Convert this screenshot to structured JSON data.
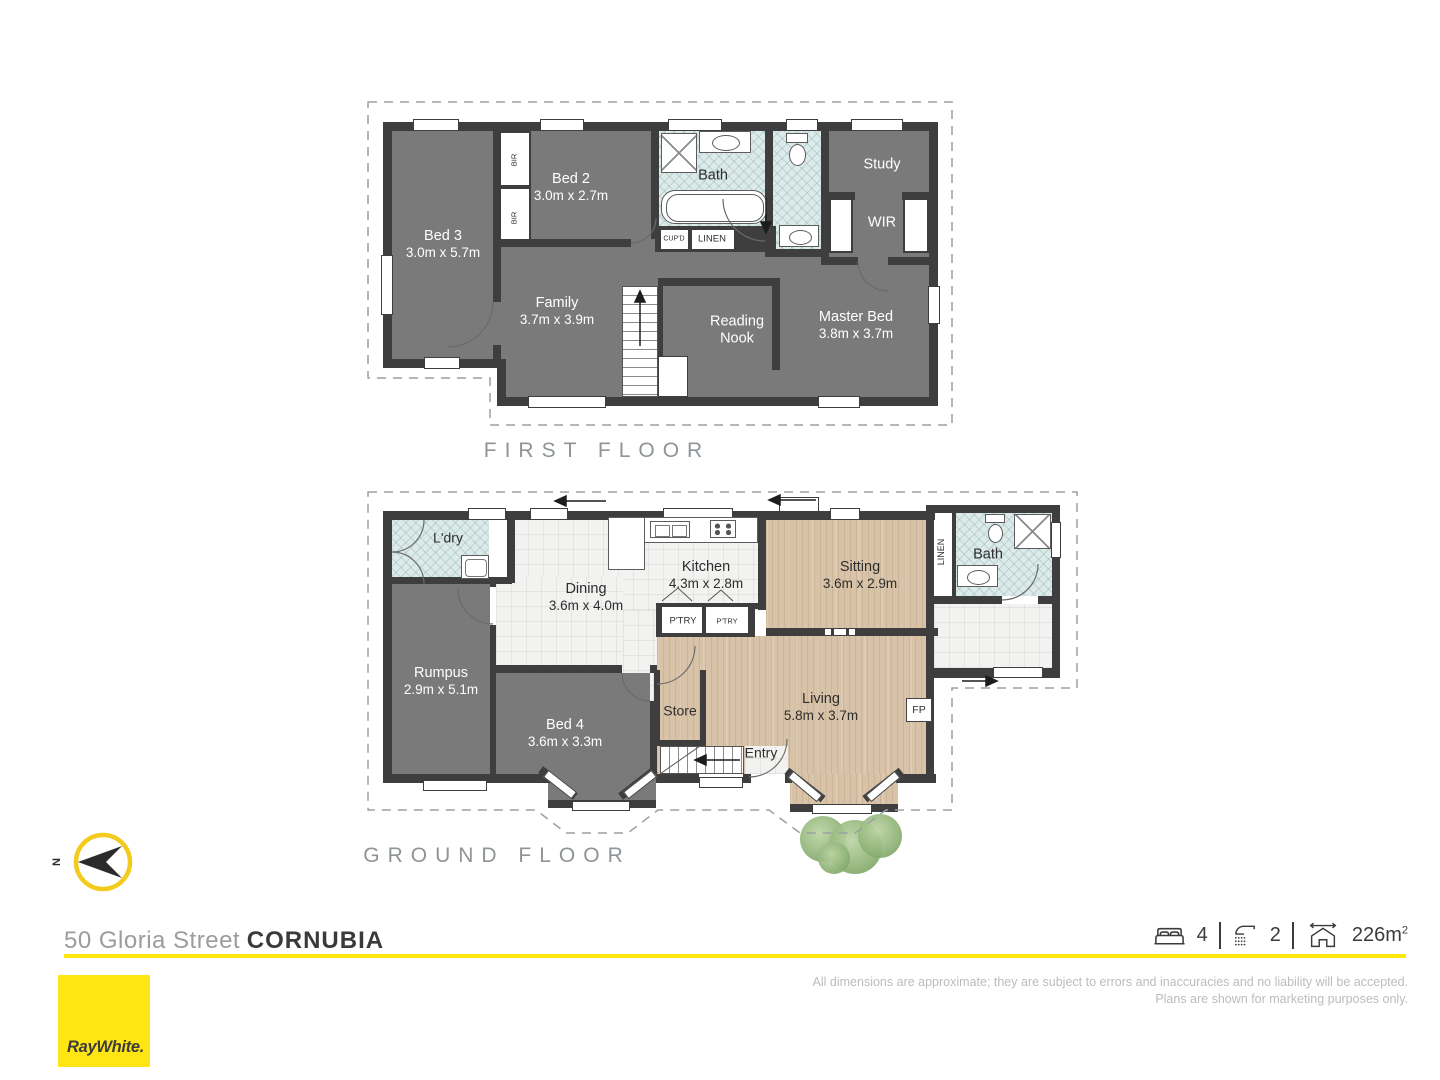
{
  "first_floor": {
    "title": "FIRST FLOOR",
    "rooms": {
      "bed3_name": "Bed 3",
      "bed3_dims": "3.0m x 5.7m",
      "bed2_name": "Bed 2",
      "bed2_dims": "3.0m x 2.7m",
      "bath": "Bath",
      "study": "Study",
      "wir": "WIR",
      "family_name": "Family",
      "family_dims": "3.7m x 3.9m",
      "nook_line1": "Reading",
      "nook_line2": "Nook",
      "master_name": "Master Bed",
      "master_dims": "3.8m x 3.7m",
      "cupd": "CUP'D",
      "linen": "LINEN",
      "bir_top": "BIR",
      "bir_bottom": "BIR"
    }
  },
  "ground_floor": {
    "title": "GROUND FLOOR",
    "rooms": {
      "laundry": "L'dry",
      "dining_name": "Dining",
      "dining_dims": "3.6m x 4.0m",
      "kitchen_name": "Kitchen",
      "kitchen_dims": "4.3m x 2.8m",
      "sitting_name": "Sitting",
      "sitting_dims": "3.6m x 2.9m",
      "rumpus_name": "Rumpus",
      "rumpus_dims": "2.9m x 5.1m",
      "bed4_name": "Bed 4",
      "bed4_dims": "3.6m x 3.3m",
      "living_name": "Living",
      "living_dims": "5.8m x 3.7m",
      "store": "Store",
      "entry": "Entry",
      "bath": "Bath",
      "linen": "LINEN",
      "pantry1": "P'TRY",
      "pantry2": "P'TRY",
      "fireplace": "FP"
    }
  },
  "compass": {
    "north": "N"
  },
  "footer": {
    "address_street": "50 Gloria Street",
    "address_suburb": "CORNUBIA",
    "stats": {
      "beds": "4",
      "showers": "2",
      "area_value": "226m",
      "area_sup": "2"
    },
    "disclaimer_line1": "All dimensions are approximate; they are subject to errors and inaccuracies and no liability will be accepted.",
    "disclaimer_line2": "Plans are shown for marketing purposes only.",
    "brand": "RayWhite."
  },
  "colors": {
    "accent_yellow": "#ffe512",
    "wall": "#3e3e3e",
    "carpet": "#7a7a7a",
    "wood": "#d9c3a8",
    "tile_blue": "#dcebe9",
    "tile_white": "#f2f2f1"
  }
}
